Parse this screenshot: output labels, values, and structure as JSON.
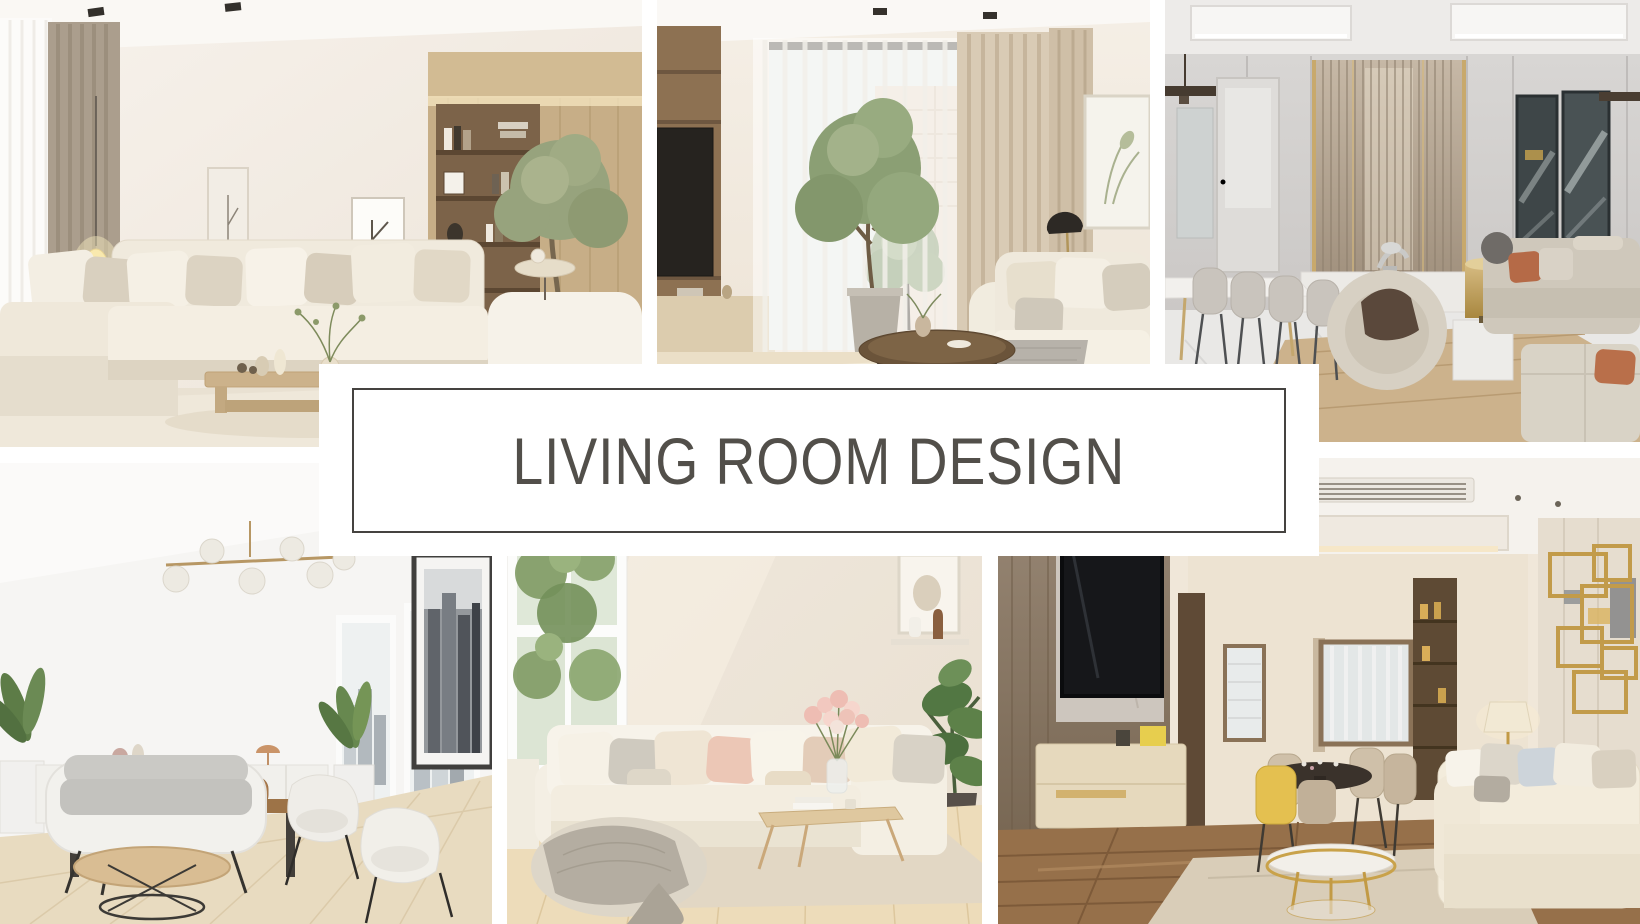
{
  "banner": {
    "title": "LIVING ROOM DESIGN"
  },
  "palette": {
    "banner_bg": "#ffffff",
    "banner_border": "#454340",
    "title_text": "#524f4a",
    "collage_gap": "#ffffff"
  },
  "collage": {
    "tiles": [
      {
        "id": "top-left",
        "alt": "Bright living room with cream sectional sofa, taupe drapes, glowing floor lamp, wood coffee table and built-in wooden shelves with a green tree"
      },
      {
        "id": "top-middle",
        "alt": "Living room with tall sheer-curtained window, potted indoor tree, TV shelving unit, beige drapes, round dark coffee table and cream sofa"
      },
      {
        "id": "top-right",
        "alt": "Elegant greige living room with dining table and chairs, slatted feature wall with gold trim, dark abstract art panels, curved armchair and gray sofas"
      },
      {
        "id": "bottom-left",
        "alt": "White Scandinavian living-dining room with brass globe chandelier, white sideboard, wood dining set, gray sofa, wire-base coffee table, armchairs and city-view windows"
      },
      {
        "id": "bottom-middle",
        "alt": "Sunny cream living room with white sectional, blush pillows, flower bouquet on wood coffee table, knit-throw pouf and tall green plant"
      },
      {
        "id": "bottom-right",
        "alt": "Warm modern living room with wood TV wall, dining nook with yellow chair, gold round coffee table, cream sofa and gold wall sculpture"
      }
    ]
  }
}
